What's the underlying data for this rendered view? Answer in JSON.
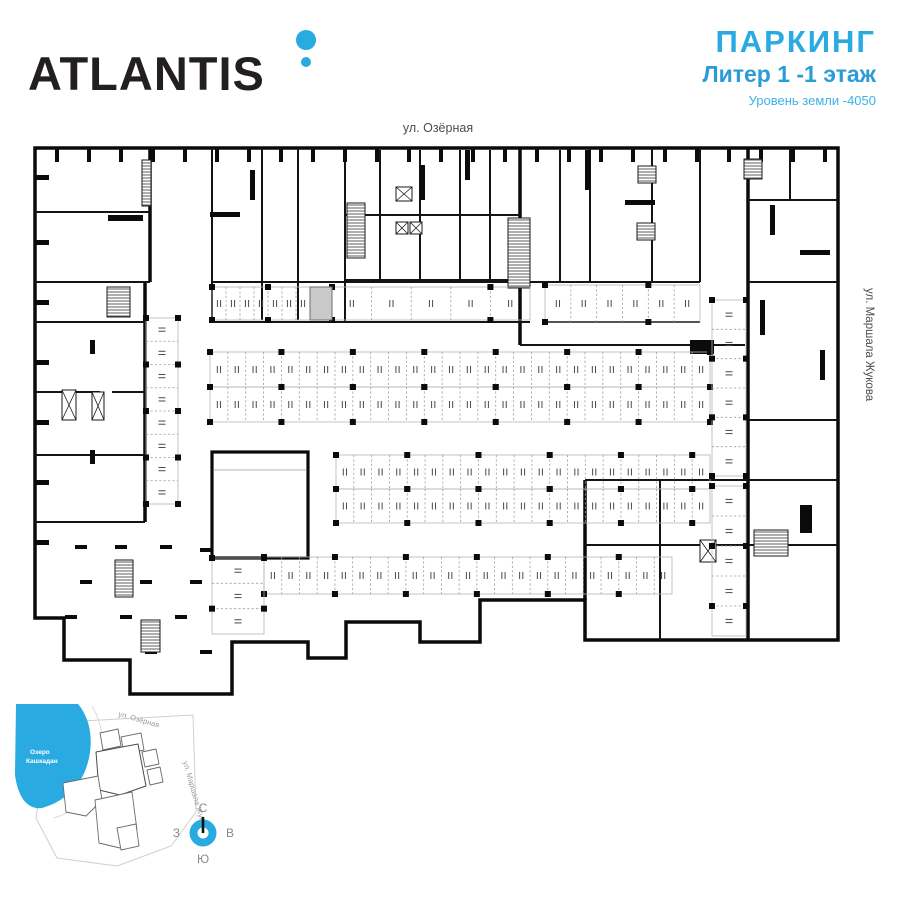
{
  "header": {
    "logo": "ATLANTIS",
    "accent_color": "#29abe2",
    "title": "ПАРКИНГ",
    "subtitle": "Литер 1  -1 этаж",
    "level_note": "Уровень земли -4050",
    "title_color": "#29abe2",
    "subtitle_color": "#2b9cd8"
  },
  "plan": {
    "street_top": "ул. Озёрная",
    "street_right": "ул. Маршала Жукова",
    "wall_color": "#141414",
    "highlight_color": "#c9c9c9",
    "parking_rows": [
      {
        "x": 212,
        "y": 287,
        "w": 98,
        "h": 33,
        "count": 7,
        "dir": "h"
      },
      {
        "x": 332,
        "y": 287,
        "w": 198,
        "h": 33,
        "count": 5,
        "dir": "h"
      },
      {
        "x": 545,
        "y": 285,
        "w": 155,
        "h": 37,
        "count": 6,
        "dir": "h"
      },
      {
        "x": 210,
        "y": 352,
        "w": 500,
        "h": 35,
        "count": 28,
        "dir": "h"
      },
      {
        "x": 210,
        "y": 387,
        "w": 500,
        "h": 35,
        "count": 28,
        "dir": "h"
      },
      {
        "x": 336,
        "y": 455,
        "w": 374,
        "h": 34,
        "count": 21,
        "dir": "h"
      },
      {
        "x": 336,
        "y": 489,
        "w": 374,
        "h": 34,
        "count": 21,
        "dir": "h"
      },
      {
        "x": 264,
        "y": 557,
        "w": 408,
        "h": 37,
        "count": 23,
        "dir": "h"
      },
      {
        "x": 212,
        "y": 558,
        "w": 52,
        "h": 76,
        "count": 3,
        "dir": "v"
      },
      {
        "x": 146,
        "y": 318,
        "w": 32,
        "h": 186,
        "count": 8,
        "dir": "v"
      },
      {
        "x": 712,
        "y": 300,
        "w": 34,
        "h": 176,
        "count": 6,
        "dir": "v"
      },
      {
        "x": 712,
        "y": 486,
        "w": 34,
        "h": 150,
        "count": 5,
        "dir": "v"
      }
    ]
  },
  "sitemap": {
    "lake_label_line1": "Озеро",
    "lake_label_line2": "Кашкадан",
    "street_top": "ул. Озёрная",
    "street_right": "ул. Маршала Жукова",
    "lake_color": "#29abe2",
    "highlight_building_color": "#ababab",
    "compass": {
      "north": "С",
      "south": "Ю",
      "west": "З",
      "east": "В",
      "ring_color": "#29abe2"
    }
  }
}
